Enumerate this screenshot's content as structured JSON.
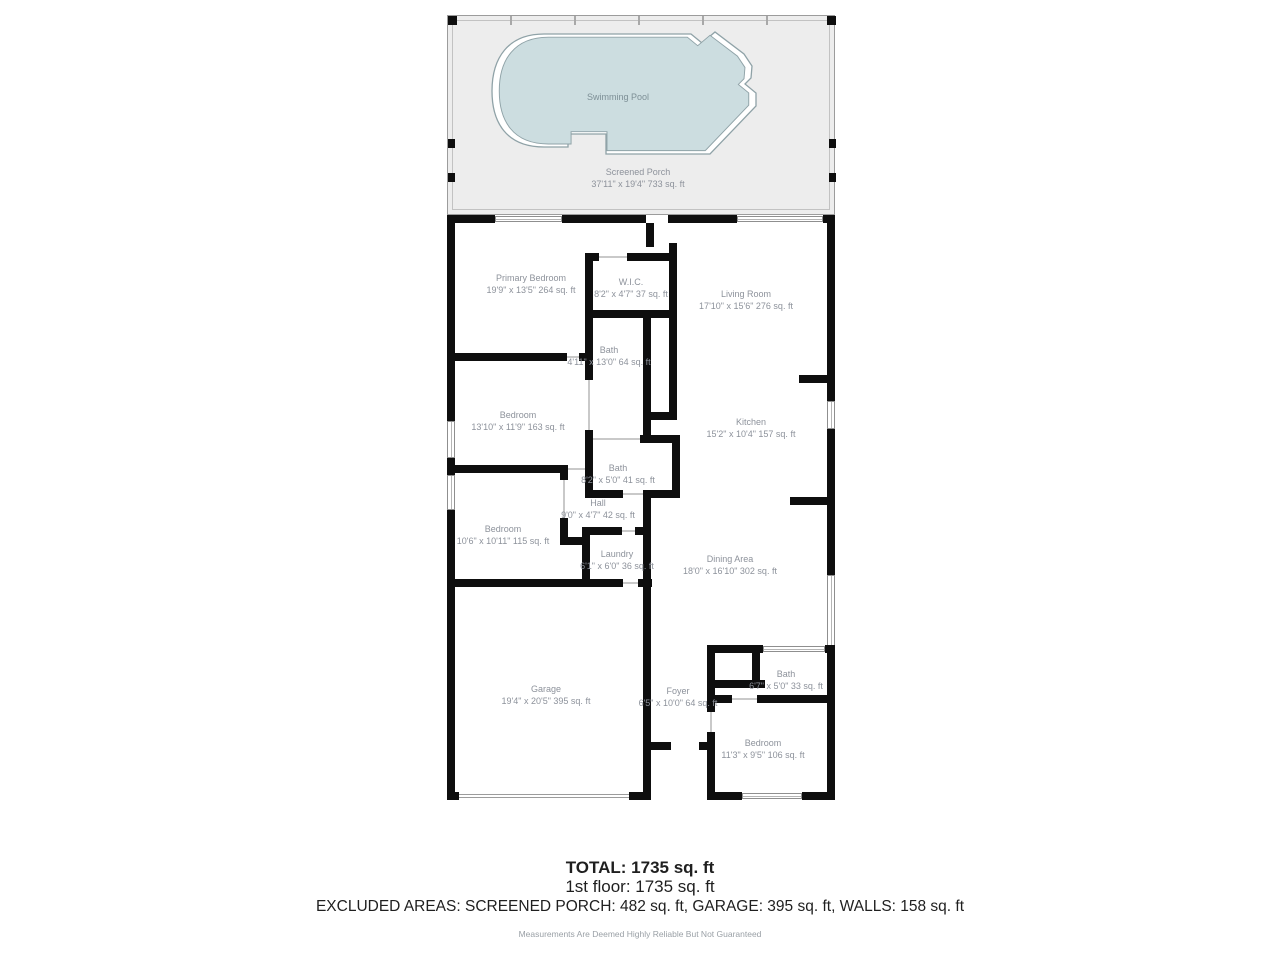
{
  "porch": {
    "pool_label": "Swimming Pool",
    "name": "Screened Porch",
    "dims": "37'11\" x 19'4\" 733 sq. ft"
  },
  "rooms": [
    {
      "name": "Primary Bedroom",
      "dims": "19'9\" x 13'5\" 264 sq. ft"
    },
    {
      "name": "W.I.C.",
      "dims": "8'2\" x 4'7\" 37 sq. ft"
    },
    {
      "name": "Living Room",
      "dims": "17'10\" x 15'6\" 276 sq. ft"
    },
    {
      "name": "Bath",
      "dims": "4'11\" x 13'0\" 64 sq. ft"
    },
    {
      "name": "Bedroom",
      "dims": "13'10\" x 11'9\" 163 sq. ft"
    },
    {
      "name": "Kitchen",
      "dims": "15'2\" x 10'4\" 157 sq. ft"
    },
    {
      "name": "Bath",
      "dims": "8'2\" x 5'0\" 41 sq. ft"
    },
    {
      "name": "Hall",
      "dims": "9'0\" x 4'7\" 42 sq. ft"
    },
    {
      "name": "Bedroom",
      "dims": "10'6\" x 10'11\" 115 sq. ft"
    },
    {
      "name": "Laundry",
      "dims": "6'1\" x 6'0\" 36 sq. ft"
    },
    {
      "name": "Dining Area",
      "dims": "18'0\" x 16'10\" 302 sq. ft"
    },
    {
      "name": "Garage",
      "dims": "19'4\" x 20'5\" 395 sq. ft"
    },
    {
      "name": "Foyer",
      "dims": "6'5\" x 10'0\" 64 sq. ft"
    },
    {
      "name": "Bath",
      "dims": "6'7\" x 5'0\" 33 sq. ft"
    },
    {
      "name": "Bedroom",
      "dims": "11'3\" x 9'5\" 106 sq. ft"
    }
  ],
  "summary": {
    "total": "TOTAL: 1735 sq. ft",
    "floor": "1st floor: 1735 sq. ft",
    "excluded": "EXCLUDED AREAS: SCREENED PORCH: 482 sq. ft, GARAGE: 395 sq. ft, WALLS: 158 sq. ft",
    "disclaimer": "Measurements Are Deemed Highly Reliable But Not Guaranteed"
  },
  "colors": {
    "wall": "#0e0e0e",
    "pool_fill": "#ccdde0",
    "pool_stroke": "#8fa2a7",
    "porch_fill": "#ededed",
    "label": "#8d929b",
    "text": "#1f1f1f"
  }
}
